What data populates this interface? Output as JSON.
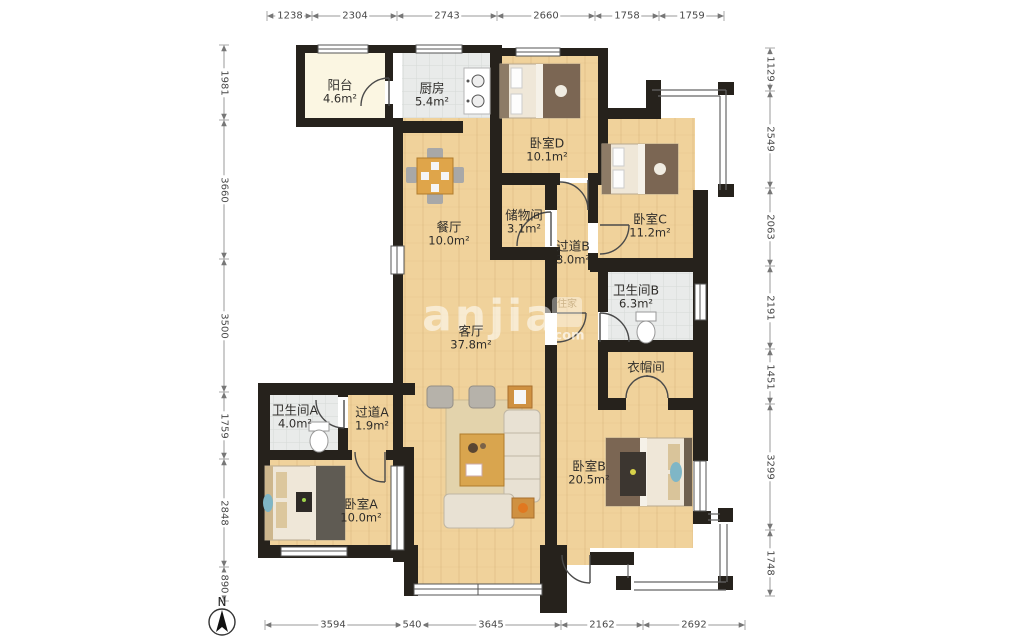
{
  "compass": {
    "label": "N"
  },
  "watermark": {
    "text": "anjia",
    "badge": "住家",
    "suffix": ".com"
  },
  "dimensions": {
    "top": [
      "1238",
      "2304",
      "2743",
      "2660",
      "1758",
      "1759"
    ],
    "bottom": [
      "3594",
      "540",
      "3645",
      "2162",
      "2692"
    ],
    "left": [
      "1981",
      "3660",
      "3500",
      "1759",
      "2848",
      "890"
    ],
    "right": [
      "1129",
      "2549",
      "2063",
      "2191",
      "1451",
      "3299",
      "1748"
    ]
  },
  "rooms": [
    {
      "name": "阳台",
      "area": "4.6m²"
    },
    {
      "name": "厨房",
      "area": "5.4m²"
    },
    {
      "name": "卧室D",
      "area": "10.1m²"
    },
    {
      "name": "卧室C",
      "area": "11.2m²"
    },
    {
      "name": "储物间",
      "area": "3.1m²"
    },
    {
      "name": "过道B",
      "area": "3.0m²"
    },
    {
      "name": "餐厅",
      "area": "10.0m²"
    },
    {
      "name": "卫生间B",
      "area": "6.3m²"
    },
    {
      "name": "衣帽间",
      "area": ""
    },
    {
      "name": "客厅",
      "area": "37.8m²"
    },
    {
      "name": "卫生间A",
      "area": "4.0m²"
    },
    {
      "name": "过道A",
      "area": "1.9m²"
    },
    {
      "name": "卧室A",
      "area": "10.0m²"
    },
    {
      "name": "卧室B",
      "area": "20.5m²"
    }
  ]
}
